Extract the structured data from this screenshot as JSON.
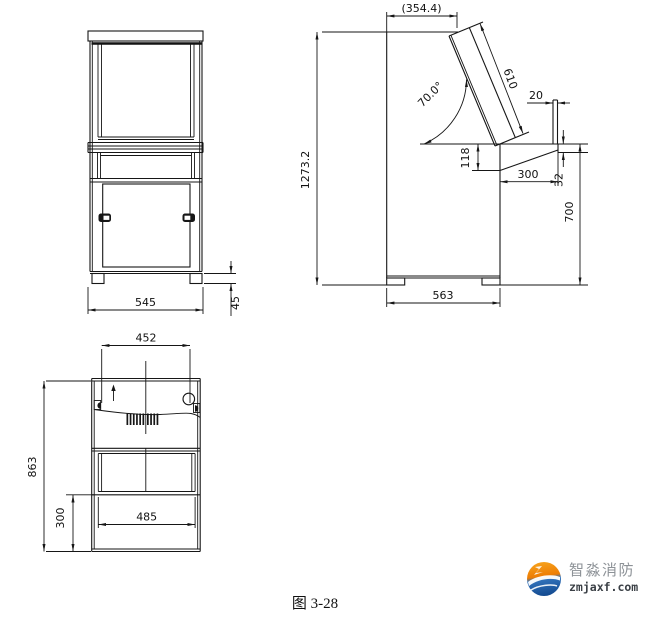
{
  "page": {
    "caption": "图 3-28"
  },
  "views": {
    "front": {
      "dims": {
        "width": "545",
        "foot_height": "45"
      }
    },
    "side": {
      "dims": {
        "top_depth": "(354.4)",
        "panel_length": "610",
        "panel_angle": "70.0°",
        "rear_lip": "20",
        "overall_height": "1273.2",
        "desk_drop": "118",
        "desk_depth": "300",
        "desk_edge": "32",
        "desk_height": "700",
        "base_depth": "563"
      }
    },
    "rear": {
      "dims": {
        "opening_width": "452",
        "section_height": "863",
        "lower_height": "300",
        "inner_width": "485"
      }
    }
  },
  "logo": {
    "title": "智淼消防",
    "domain": "zmjaxf.com",
    "orange": "#f08300",
    "blue": "#1f5fae"
  }
}
